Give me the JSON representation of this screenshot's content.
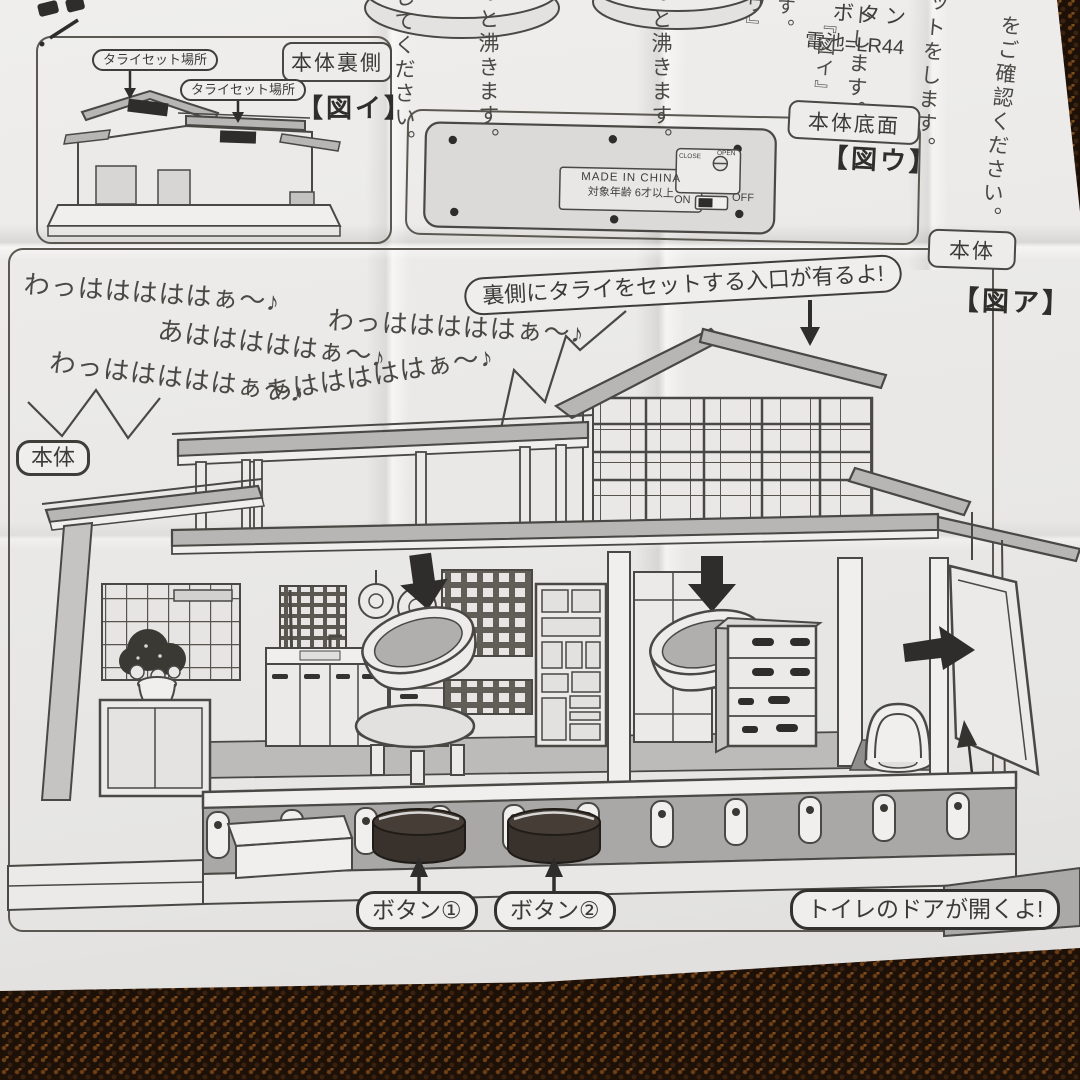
{
  "colors": {
    "paper": "#eae9e7",
    "ink": "#44423e",
    "roof_gray": "#b7b6b4",
    "arrow_black": "#2f2d2b",
    "carpet_brown": "#1d1007",
    "button_dark": "#38312c"
  },
  "top_strip": {
    "battery_label": "ボタン",
    "battery_value": "電池=LR44",
    "columns": {
      "c1": "してください。",
      "c2": "っと沸きます。",
      "c3": "っと沸きます。",
      "c4": "ウ』",
      "c5": "す。",
      "c6": "『図イ』",
      "c7": "トします。",
      "c8": "ットをします。",
      "c9": "』をご確認ください。"
    }
  },
  "figure_i": {
    "panel_label": "本体裏側",
    "figure_label": "【図イ】",
    "tarai_callout_1": "タライセット場所",
    "tarai_callout_2": "タライセット場所"
  },
  "figure_u": {
    "panel_label": "本体底面",
    "figure_label": "【図ウ】",
    "origin_text": "MADE IN CHINA",
    "age_text": "対象年齢 6才以上",
    "switch_on": "ON",
    "switch_off": "OFF",
    "door_close": "CLOSE",
    "door_open": "OPEN"
  },
  "figure_a": {
    "panel_label": "本体",
    "figure_label": "【図ア】",
    "body_label": "本体",
    "rear_callout": "裏側にタライをセットする入口が有るよ!",
    "laughs": [
      "わっはははははぁ〜♪",
      "あはははははぁ〜♪",
      "わっはははははぁ〜♪",
      "わっはははははぁ〜♪",
      "あはははははぁ〜♪"
    ],
    "button_1": "ボタン①",
    "button_2": "ボタン②",
    "toilet_callout": "トイレのドアが開くよ!"
  }
}
